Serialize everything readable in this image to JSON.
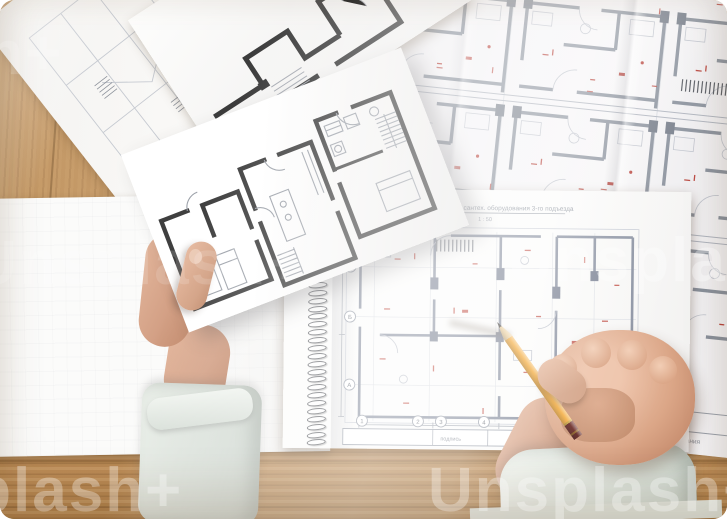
{
  "watermark": {
    "text": "Unsplash+",
    "color": "#ffffff"
  },
  "palette": {
    "wood": "#c49465",
    "paper": "#f7f6f4",
    "wall_dark": "#3f3f3f",
    "wall_grey": "#8a919c",
    "annotation_red": "#b8443c",
    "sleeve": "#dfe6e1",
    "skin": "#d9a88d",
    "pencil_body": "#f3ab3d"
  },
  "pad_plan": {
    "title": "Схема расположения сантех. оборудования 3-го подъезда",
    "scale": "1 : 50",
    "axis_letters": [
      "В",
      "Б",
      "А"
    ],
    "axis_numbers": [
      "1",
      "2",
      "3",
      "4"
    ],
    "titleblock_label": "подпись",
    "sheet_number": "13"
  },
  "right_sheet": {
    "footer_note": "Зона сантехоборудования"
  }
}
